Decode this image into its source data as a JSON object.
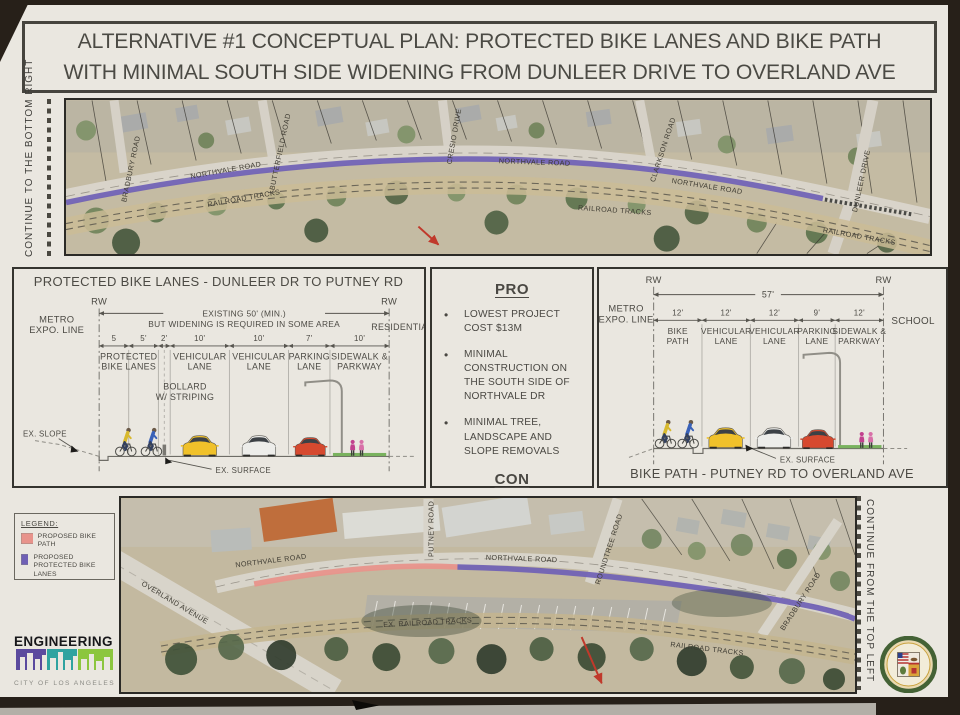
{
  "poster": {
    "title_line1": "ALTERNATIVE #1 CONCEPTUAL PLAN: PROTECTED BIKE LANES AND BIKE PATH",
    "title_line2": "WITH MINIMAL SOUTH SIDE WIDENING FROM DUNLEER DRIVE TO OVERLAND AVE"
  },
  "colors": {
    "proposed_bike_path": "#e8938b",
    "proposed_protected_bike_lanes": "#6f60b5"
  },
  "top_map": {
    "continue_label": "CONTINUE TO THE BOTTOM RIGHT",
    "labels": {
      "bradbury": "BRADBURY ROAD",
      "northvale_1": "NORTHVALE ROAD",
      "butterfield": "BUTTERFIELD ROAD",
      "cresio": "CRESIO DRIVE",
      "northvale_2": "NORTHVALE ROAD",
      "clarkson": "CLARKSON ROAD",
      "northvale_3": "NORTHVALE ROAD",
      "dunleer": "DUNLEER DRIVE",
      "railroad_1": "RAILROAD TRACKS",
      "railroad_2": "RAILROAD TRACKS",
      "railroad_3": "RAILROAD TRACKS"
    }
  },
  "section_left": {
    "title": "PROTECTED BIKE LANES - DUNLEER DR TO PUTNEY RD",
    "rw": "RW",
    "context_left": [
      "METRO",
      "EXPO. LINE"
    ],
    "context_right": "RESIDENTIAL",
    "span_note": [
      "EXISTING  50' (MIN.)",
      "BUT WIDENING IS REQUIRED IN SOME AREA"
    ],
    "dims": [
      "5",
      "5'",
      "2'",
      "10'",
      "10'",
      "7'",
      "10'"
    ],
    "lanes": [
      [
        "PROTECTED",
        "BIKE LANES"
      ],
      [
        "VEHICULAR",
        "LANE"
      ],
      [
        "VEHICULAR",
        "LANE"
      ],
      [
        "PARKING",
        "LANE"
      ],
      [
        "SIDEWALK &",
        "PARKWAY"
      ]
    ],
    "bollard_note": [
      "BOLLARD",
      "W/ STRIPING"
    ],
    "ex_slope": "EX. SLOPE",
    "ex_surface": "EX. SURFACE"
  },
  "pros_cons": {
    "pro_heading": "PRO",
    "pro_items": [
      "LOWEST PROJECT COST $13M",
      "MINIMAL CONSTRUCTION ON THE SOUTH SIDE OF NORTHVALE DR",
      "MINIMAL TREE, LANDSCAPE AND SLOPE REMOVALS"
    ],
    "con_heading": "CON",
    "con_items": [
      "TAKE AWAY ONE PARKING LANE ON THE SOUTH SIDE OF NORTHVALE RD"
    ]
  },
  "section_right": {
    "title": "BIKE PATH - PUTNEY RD TO OVERLAND AVE",
    "rw": "RW",
    "context_left": [
      "METRO",
      "EXPO. LINE"
    ],
    "context_right": "SCHOOL",
    "total_width": "57'",
    "dims": [
      "12'",
      "12'",
      "12'",
      "9'",
      "12'"
    ],
    "lanes": [
      [
        "BIKE",
        "PATH"
      ],
      [
        "VEHICULAR",
        "LANE"
      ],
      [
        "VEHICULAR",
        "LANE"
      ],
      [
        "PARKING",
        "LANE"
      ],
      [
        "SIDEWALK &",
        "PARKWAY"
      ]
    ],
    "ex_surface": "EX. SURFACE"
  },
  "bottom_map": {
    "continue_label": "CONTINUE FROM THE TOP LEFT",
    "legend": {
      "heading": "LEGEND:",
      "items": [
        {
          "label": "PROPOSED BIKE PATH"
        },
        {
          "label": "PROPOSED PROTECTED BIKE LANES"
        }
      ]
    },
    "labels": {
      "overland": "OVERLAND AVENUE",
      "northvale_1": "NORTHVALE ROAD",
      "putney": "PUTNEY ROAD",
      "northvale_2": "NORTHVALE ROAD",
      "roundtree": "ROUNDTREE ROAD",
      "ex_railroad": "EX. RAILROAD TRACKS",
      "railroad": "RAILROAD TRACKS",
      "bradbury": "BRADBURY ROAD"
    }
  },
  "footer": {
    "engineering": "ENGINEERING",
    "city_of_la": "CITY OF LOS ANGELES"
  }
}
